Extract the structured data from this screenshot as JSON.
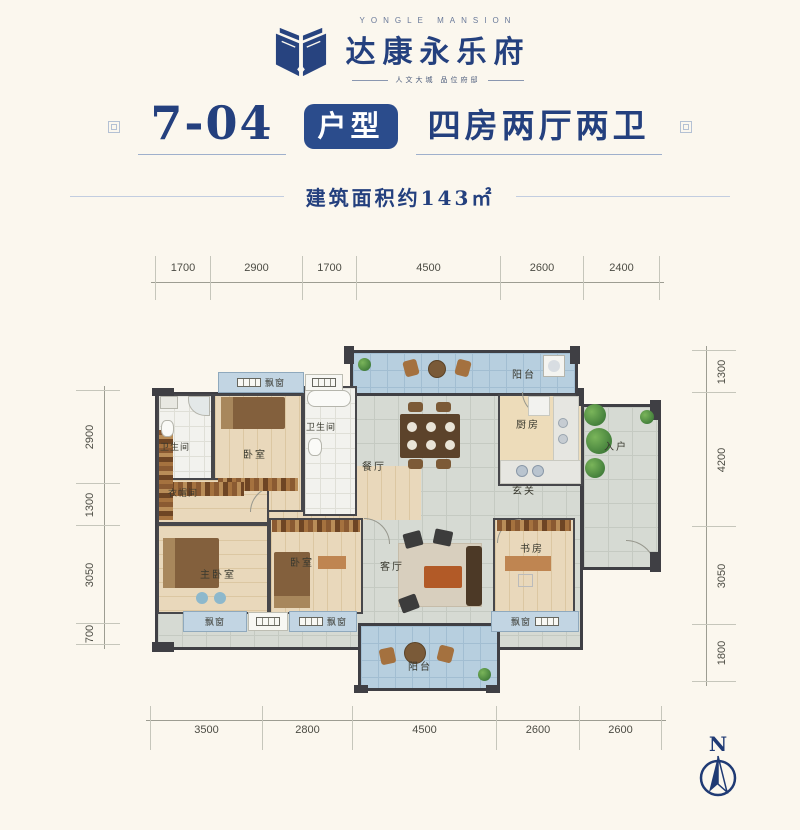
{
  "brand": {
    "name_en": "YONGLE MANSION",
    "name_cn": "达康永乐府",
    "tagline": "人文大城  品位府邸"
  },
  "title": {
    "unit": "7-04",
    "badge": "户型",
    "layout": "四房两厅两卫"
  },
  "area_note": "建筑面积约143㎡",
  "dimensions": {
    "top": [
      "1700",
      "2900",
      "1700",
      "4500",
      "2600",
      "2400"
    ],
    "bottom": [
      "3500",
      "2800",
      "4500",
      "2600",
      "2600"
    ],
    "left": [
      "2900",
      "1300",
      "3050",
      "700"
    ],
    "right": [
      "1300",
      "4200",
      "3050",
      "1800"
    ]
  },
  "rooms": {
    "balcony": "阳台",
    "bath": "卫生间",
    "bedroom": "卧室",
    "dining": "餐厅",
    "kitchen": "厨房",
    "entry": "入户",
    "hall": "玄关",
    "cloak": "衣帽间",
    "master": "主卧室",
    "living": "客厅",
    "study": "书房",
    "bay_window": "飘窗"
  },
  "compass": {
    "label": "N"
  },
  "colors": {
    "primary_blue": "#24407e",
    "badge_blue": "#2b4c8c",
    "wall": "#3f3f44",
    "balcony_tile": "#b7cfdf",
    "wood_floor": "#e9d8bb",
    "gray_tile": "#d6dad3",
    "background": "#fbf7ee"
  }
}
